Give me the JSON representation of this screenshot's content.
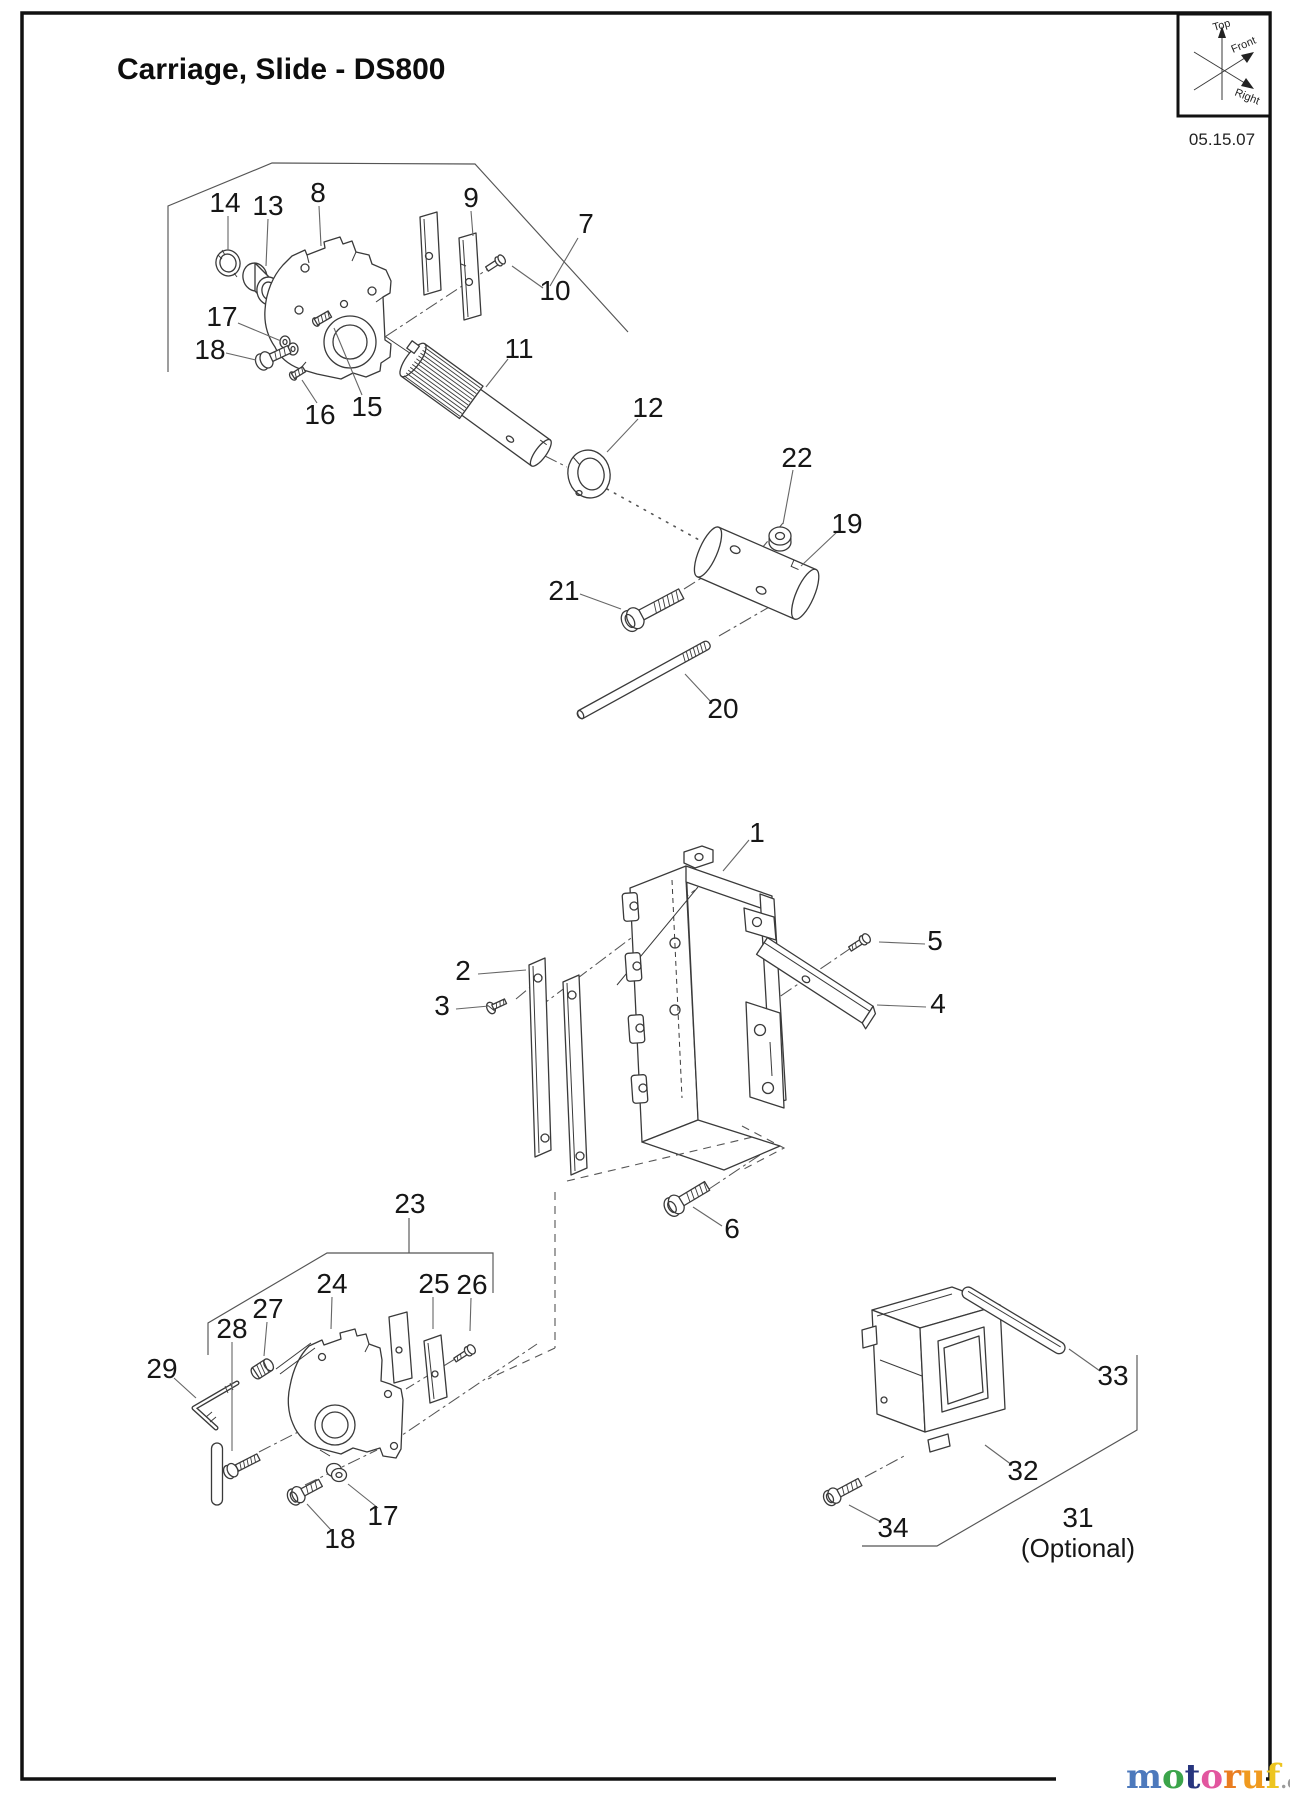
{
  "page": {
    "title": "Carriage, Slide - DS800",
    "date": "05.15.07"
  },
  "compass": {
    "top": "Top",
    "front": "Front",
    "right": "Right"
  },
  "watermark": {
    "letters": [
      {
        "ch": "m",
        "color": "#4d79bc"
      },
      {
        "ch": "o",
        "color": "#3ba44a"
      },
      {
        "ch": "t",
        "color": "#27357e"
      },
      {
        "ch": "o",
        "color": "#e2569f"
      },
      {
        "ch": "r",
        "color": "#ea7d20"
      },
      {
        "ch": "u",
        "color": "#f09a1f"
      },
      {
        "ch": "f",
        "color": "#edc520"
      }
    ],
    "suffix": ".de",
    "suffix_color": "#9a9a9a"
  },
  "diagram": {
    "labels": [
      {
        "id": "1",
        "text": "1",
        "x": 757,
        "y": 842
      },
      {
        "id": "2",
        "text": "2",
        "x": 463,
        "y": 980
      },
      {
        "id": "3",
        "text": "3",
        "x": 442,
        "y": 1015
      },
      {
        "id": "4",
        "text": "4",
        "x": 938,
        "y": 1013
      },
      {
        "id": "5",
        "text": "5",
        "x": 935,
        "y": 950
      },
      {
        "id": "6",
        "text": "6",
        "x": 732,
        "y": 1238
      },
      {
        "id": "7",
        "text": "7",
        "x": 586,
        "y": 233
      },
      {
        "id": "8",
        "text": "8",
        "x": 318,
        "y": 202
      },
      {
        "id": "9",
        "text": "9",
        "x": 471,
        "y": 207
      },
      {
        "id": "10",
        "text": "10",
        "x": 555,
        "y": 300
      },
      {
        "id": "11",
        "text": "11",
        "x": 519,
        "y": 358
      },
      {
        "id": "12",
        "text": "12",
        "x": 648,
        "y": 417
      },
      {
        "id": "13",
        "text": "13",
        "x": 268,
        "y": 215
      },
      {
        "id": "14",
        "text": "14",
        "x": 225,
        "y": 212
      },
      {
        "id": "15",
        "text": "15",
        "x": 367,
        "y": 416
      },
      {
        "id": "16",
        "text": "16",
        "x": 320,
        "y": 424
      },
      {
        "id": "17-top",
        "text": "17",
        "x": 222,
        "y": 326
      },
      {
        "id": "18-top",
        "text": "18",
        "x": 210,
        "y": 359
      },
      {
        "id": "19",
        "text": "19",
        "x": 847,
        "y": 533
      },
      {
        "id": "20",
        "text": "20",
        "x": 723,
        "y": 718
      },
      {
        "id": "21",
        "text": "21",
        "x": 564,
        "y": 600
      },
      {
        "id": "22",
        "text": "22",
        "x": 797,
        "y": 467
      },
      {
        "id": "23",
        "text": "23",
        "x": 410,
        "y": 1213
      },
      {
        "id": "24",
        "text": "24",
        "x": 332,
        "y": 1293
      },
      {
        "id": "25",
        "text": "25",
        "x": 434,
        "y": 1293
      },
      {
        "id": "26",
        "text": "26",
        "x": 472,
        "y": 1294
      },
      {
        "id": "27",
        "text": "27",
        "x": 268,
        "y": 1318
      },
      {
        "id": "28",
        "text": "28",
        "x": 232,
        "y": 1338
      },
      {
        "id": "29",
        "text": "29",
        "x": 162,
        "y": 1378
      },
      {
        "id": "31",
        "text": "31",
        "x": 1078,
        "y": 1527
      },
      {
        "id": "32",
        "text": "32",
        "x": 1023,
        "y": 1480
      },
      {
        "id": "33",
        "text": "33",
        "x": 1113,
        "y": 1385
      },
      {
        "id": "34",
        "text": "34",
        "x": 893,
        "y": 1537
      },
      {
        "id": "17-bottom",
        "text": "17",
        "x": 383,
        "y": 1525
      },
      {
        "id": "18-bottom",
        "text": "18",
        "x": 340,
        "y": 1548
      },
      {
        "id": "optional-note",
        "text": "(Optional)",
        "x": 1078,
        "y": 1557,
        "cls": "opt"
      }
    ]
  }
}
